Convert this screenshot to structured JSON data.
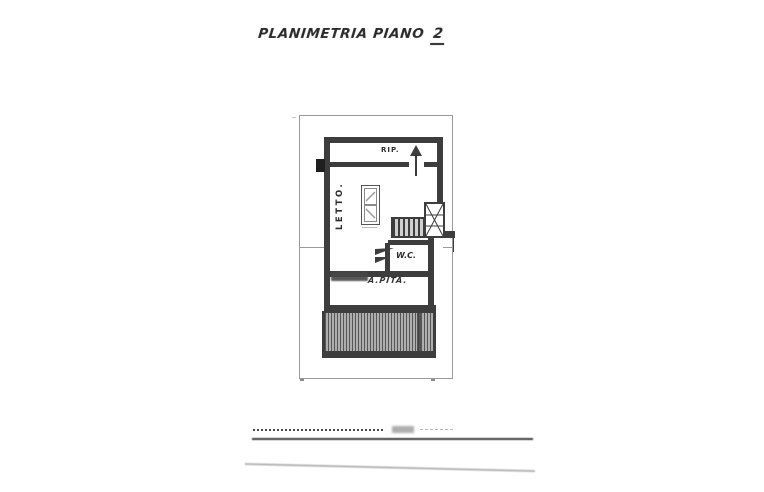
{
  "page": {
    "title": "PLANIMETRIA PIANO",
    "floor_number": "2"
  },
  "plan": {
    "labels": {
      "storage": "RIP.",
      "bedroom": "LETTO.",
      "wc": "W.C.",
      "attic": "A.PITA."
    },
    "features": {
      "boundary": "property-line-rectangle",
      "stairs": "staircase-with-winders",
      "terrace": "hatched-terrace",
      "entrance_arrow": "up-arrow",
      "wc_door": "door-swing",
      "wardrobe": "two-cell-closet-symbol"
    },
    "colors": {
      "ink": "#3d3d3d",
      "ink_light": "#9a9a9a",
      "paper": "#ffffff"
    }
  },
  "footer": {
    "rules": "dotted-signature-line-and-solid-rule"
  }
}
